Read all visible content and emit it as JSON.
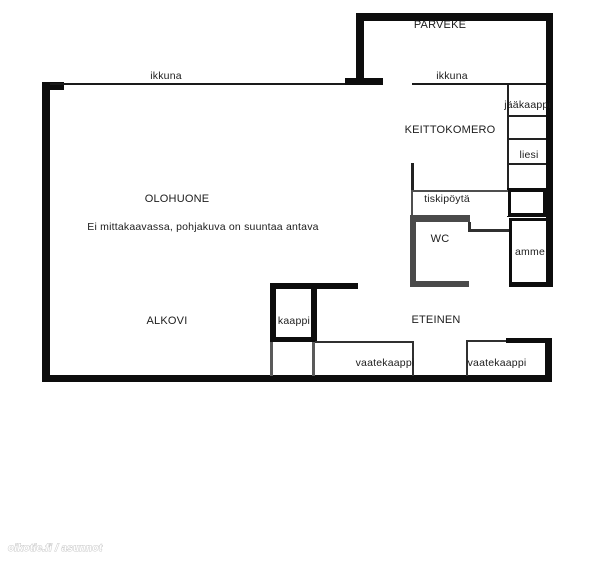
{
  "floorplan": {
    "disclaimer": "Ei mittakaavassa, pohjakuva on suuntaa antava",
    "watermark": "oikotie.fi / asunnot",
    "rooms": {
      "parveke": "PARVEKE",
      "olohuone": "OLOHUONE",
      "keittokomero": "KEITTOKOMERO",
      "wc": "WC",
      "alkovi": "ALKOVI",
      "eteinen": "ETEINEN"
    },
    "fixtures": {
      "ikkuna_olohuone": "ikkuna",
      "ikkuna_keittokomero": "ikkuna",
      "jaakaappi": "jääkaappi",
      "liesi": "liesi",
      "tiskipoyta": "tiskipöytä",
      "amme": "amme",
      "kaappi": "kaappi",
      "vaatekaappi_left": "vaatekaappi",
      "vaatekaappi_right": "vaatekaappi"
    },
    "colors": {
      "wall_black": "#0d0d0d",
      "wall_gray": "#4a4a4a",
      "text": "#1c1c1c",
      "background": "#ffffff"
    }
  }
}
